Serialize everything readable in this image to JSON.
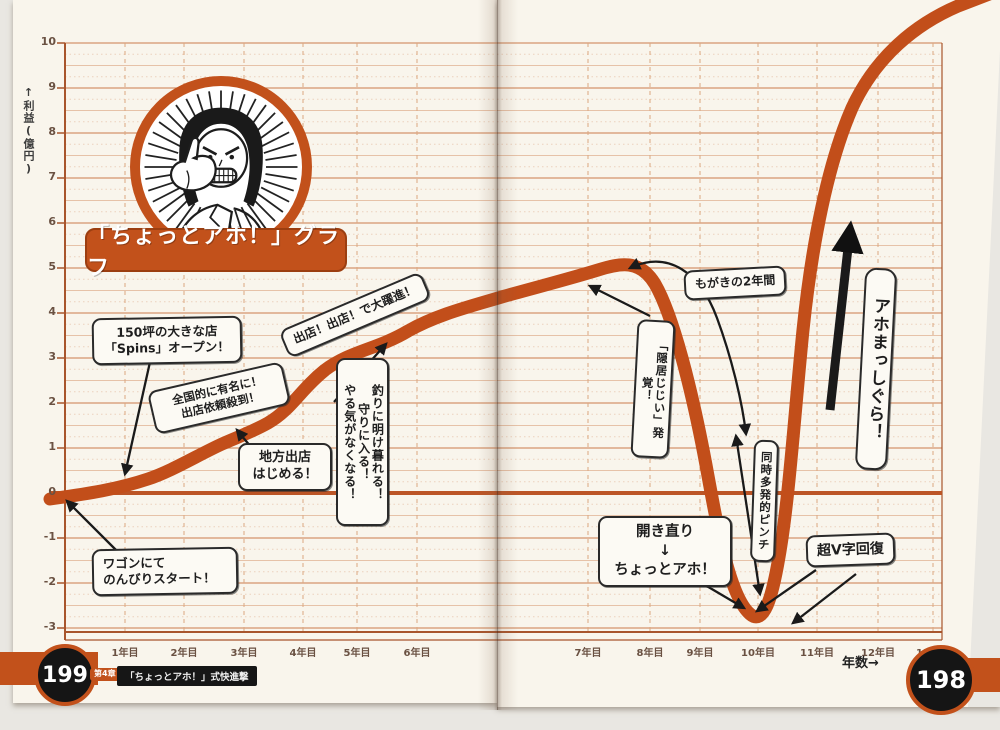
{
  "book": {
    "left_page_number": "199",
    "right_page_number": "198",
    "chapter_badge": "第4章",
    "chapter_title": "「ちょっとアホ！」式快進撃"
  },
  "chart_data": {
    "type": "line",
    "title": "「ちょっとアホ！」グラフ",
    "ylabel": "↑利益(億円)",
    "xlabel": "年数→",
    "x_ticks": [
      "1年目",
      "2年目",
      "3年目",
      "4年目",
      "5年目",
      "6年目",
      "7年目",
      "8年目",
      "9年目",
      "10年目",
      "11年目",
      "12年目",
      "13年目"
    ],
    "y_ticks": [
      10,
      9,
      8,
      7,
      6,
      5,
      4,
      3,
      2,
      1,
      0,
      -1,
      -2,
      -3
    ],
    "ylim": [
      -3,
      10
    ],
    "grid": true,
    "line_color": "#c24e1a",
    "series": [
      {
        "name": "利益(億円)",
        "x_years": [
          0,
          1,
          2,
          3,
          4,
          5,
          6,
          7,
          8,
          9,
          10,
          11,
          12,
          13
        ],
        "values_approx": [
          0,
          0.2,
          0.8,
          1.4,
          2.7,
          3.2,
          3.9,
          4.9,
          4.7,
          1.0,
          -2.9,
          7.5,
          9.7,
          10.8
        ]
      }
    ],
    "annotations": [
      {
        "text": "ワゴンにて\nのんびりスタート！"
      },
      {
        "text": "150坪の大きな店\n「Spins」オープン！"
      },
      {
        "text": "全国的に有名に！\n出店依頼殺到！"
      },
      {
        "text": "地方出店\nはじめる！"
      },
      {
        "text": "出店！出店！で大躍進！"
      },
      {
        "text": "やる気がなくなる！\n守りに入る！\n釣りに明け暮れる！"
      },
      {
        "text": "もがきの2年間"
      },
      {
        "text": "「隠居じじい」発覚！"
      },
      {
        "text": "同時多発的ピンチ"
      },
      {
        "text": "開き直り\n↓\nちょっとアホ！"
      },
      {
        "text": "超V字回復"
      },
      {
        "text": "アホまっしぐら！"
      }
    ]
  }
}
